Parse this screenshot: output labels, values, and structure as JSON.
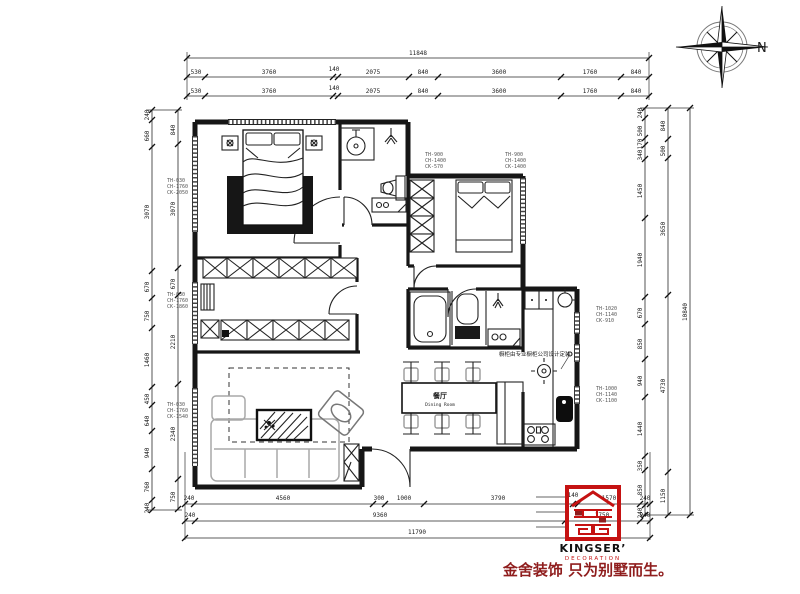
{
  "title": "residential floor plan drawing",
  "compass": {
    "label": "N"
  },
  "rooms": {
    "dining": {
      "name": "餐厅",
      "name_en": "Dining Room"
    }
  },
  "annotations": {
    "cabinet_note": "橱柜由专业橱柜公司设计定装"
  },
  "window_tags": {
    "lt": [
      "TH-030",
      "CH-1760",
      "CK-2050"
    ],
    "lm": [
      "TH-030",
      "CH-1760",
      "CK-1860"
    ],
    "lb": [
      "TH-030",
      "CH-1760",
      "CK-1540"
    ],
    "b2a": [
      "TH-900",
      "CH-1400",
      "CK-570"
    ],
    "b2b": [
      "TH-900",
      "CH-1400",
      "CK-1400"
    ],
    "rm": [
      "TH-1020",
      "CH-1140",
      "CK-910"
    ],
    "rl": [
      "TH-1000",
      "CH-1140",
      "CK-1100"
    ]
  },
  "dimensions": {
    "top": {
      "total": "11848",
      "row2": [
        "530",
        "3760",
        "140",
        "2075",
        "840",
        "3600",
        "1760",
        "840"
      ],
      "row3": [
        "530",
        "3760",
        "140",
        "2075",
        "840",
        "3600",
        "1760",
        "840"
      ]
    },
    "bottom": {
      "row1": [
        "240",
        "4560",
        "300",
        "1000",
        "3790",
        "140",
        "1570",
        "240"
      ],
      "row2": [
        "240",
        "9360",
        "1750",
        "240"
      ],
      "total": "11790"
    },
    "left": {
      "outer": [
        "240",
        "660",
        "3070",
        "670",
        "750",
        "1460",
        "450",
        "640",
        "940",
        "760",
        "240"
      ],
      "inner": [
        "840",
        "3070",
        "670",
        "2210",
        "2340",
        "750"
      ]
    },
    "right": {
      "inner": [
        "240",
        "500",
        "170",
        "340",
        "1450",
        "1940",
        "670",
        "850",
        "940",
        "1440",
        "350",
        "850",
        "240"
      ],
      "outer": [
        "840",
        "500",
        "3650",
        "4730",
        "1150"
      ],
      "total": "10840"
    }
  },
  "logo": {
    "brand": "KINGSER’",
    "subtitle": "DECORATION",
    "slogan": "金舍装饰 只为别墅而生。"
  }
}
